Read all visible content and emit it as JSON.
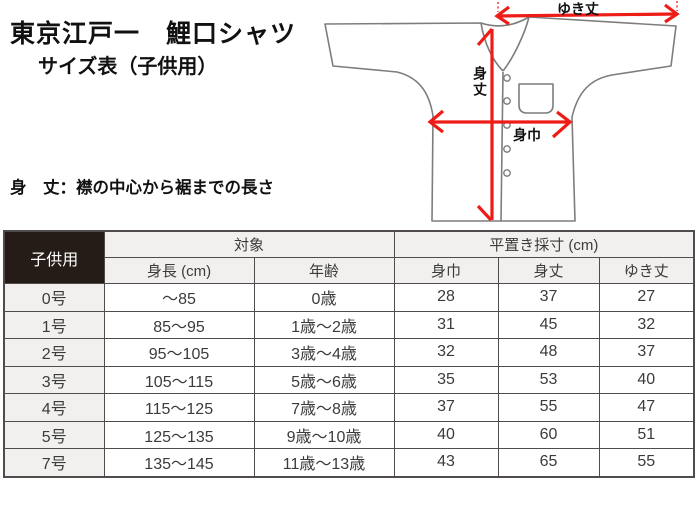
{
  "page": {
    "title": "東京江戸一　鯉口シャツ",
    "subtitle": "サイズ表（子供用）"
  },
  "definitions": {
    "body_length": "身　丈：襟の中心から裾までの長さ",
    "body_width": "身　巾：左の脇下から右の脇下までの長さ",
    "sleeve_length": "ゆき丈：襟の中心から袖口までを直線で測った長さ"
  },
  "diagram": {
    "label_sleeve_length": "ゆき丈",
    "label_body_length": "身丈",
    "label_body_width": "身巾"
  },
  "colors": {
    "arrow_red": "#ee1c17",
    "shirt_outline": "#7d7d7d",
    "table_border": "#4f4c4b",
    "header_bg": "#f2f0ef",
    "corner_cell_bg": "#251c18"
  },
  "table": {
    "corner": "子供用",
    "group_target": "対象",
    "group_flat_measure": "平置き採寸 (cm)",
    "col_height": "身長 (cm)",
    "col_age": "年齢",
    "col_body_width": "身巾",
    "col_body_length": "身丈",
    "col_sleeve": "ゆき丈",
    "rows": [
      {
        "size": "0号",
        "height": "～85",
        "age": "0歳",
        "body_width": "28",
        "body_length": "37",
        "sleeve": "27"
      },
      {
        "size": "1号",
        "height": "85～95",
        "age": "1歳～2歳",
        "body_width": "31",
        "body_length": "45",
        "sleeve": "32"
      },
      {
        "size": "2号",
        "height": "95～105",
        "age": "3歳～4歳",
        "body_width": "32",
        "body_length": "48",
        "sleeve": "37"
      },
      {
        "size": "3号",
        "height": "105～115",
        "age": "5歳～6歳",
        "body_width": "35",
        "body_length": "53",
        "sleeve": "40"
      },
      {
        "size": "4号",
        "height": "115～125",
        "age": "7歳～8歳",
        "body_width": "37",
        "body_length": "55",
        "sleeve": "47"
      },
      {
        "size": "5号",
        "height": "125～135",
        "age": "9歳～10歳",
        "body_width": "40",
        "body_length": "60",
        "sleeve": "51"
      },
      {
        "size": "7号",
        "height": "135～145",
        "age": "11歳～13歳",
        "body_width": "43",
        "body_length": "65",
        "sleeve": "55"
      }
    ]
  }
}
